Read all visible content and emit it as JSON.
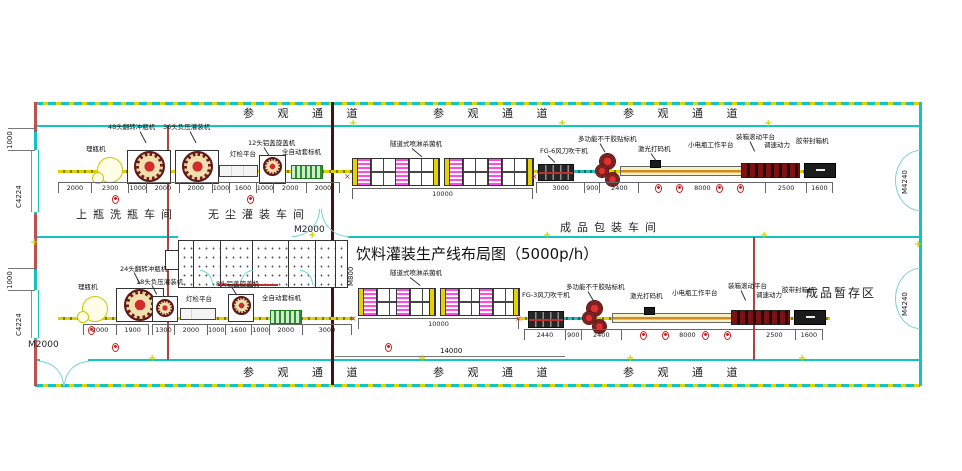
{
  "title": "饮料灌装生产线布局图（5000p/h）",
  "corridor": {
    "label": "参 观 通 道"
  },
  "rooms": {
    "wash": "上瓶洗瓶车间",
    "filling": "无尘灌装车间",
    "packing": "成品包装车间",
    "storage": "成品暂存区"
  },
  "openings": {
    "door_center": "M2000",
    "door_block": "M800",
    "door_bottom_left": "M2000",
    "door_right": "M4240",
    "window_left": "C4224",
    "window_dim": "1000",
    "bottom_dim": "14000"
  },
  "line1": {
    "labels": {
      "unscrambler": "理瓶机",
      "rinser": "48头翻转冲瓶机",
      "filler": "36头负压灌装机",
      "inspection": "灯检平台",
      "capper": "12头铝盖旋盖机",
      "sleever": "全自动套标机",
      "sterilizer": "隧道式喷淋杀菌机",
      "dryer": "FG-6风刀吹干机",
      "labeler": "多功能不干胶贴标机",
      "laser": "激光打码机",
      "platform": "小电瓶工作平台",
      "packer": "装箱滚动平台",
      "power": "调速动力",
      "sealer": "胶带封箱机"
    },
    "dims_left": [
      "2000",
      "2300",
      "1000",
      "2000",
      "2000",
      "1000",
      "1600",
      "1000",
      "2000",
      "2000"
    ],
    "dim_tunnel": "10000",
    "dims_right": [
      "3000",
      "900",
      "2400",
      "8000",
      "2500",
      "1600"
    ]
  },
  "line2": {
    "labels": {
      "unscrambler": "理瓶机",
      "rinser": "24头翻转冲瓶机",
      "filler": "18头负压灌装机",
      "inspection": "灯检平台",
      "capper": "8头铝盖旋盖机",
      "sleever": "全自动套标机",
      "sterilizer": "隧道式喷淋杀菌机",
      "dryer": "FG-3风刀吹干机",
      "labeler": "多功能不干胶贴标机",
      "laser": "激光打码机",
      "platform": "小电瓶工作平台",
      "packer": "装箱滚动平台",
      "power": "调速动力",
      "sealer": "胶带封箱机"
    },
    "dims_left": [
      "2000",
      "1900"
    ],
    "dims_mid": [
      "1300",
      "2000",
      "1000",
      "1600",
      "1000",
      "2000",
      "3000"
    ],
    "dim_tunnel": "10000",
    "dims_right": [
      "2440",
      "900",
      "2400",
      "8000",
      "2500",
      "1600"
    ]
  }
}
